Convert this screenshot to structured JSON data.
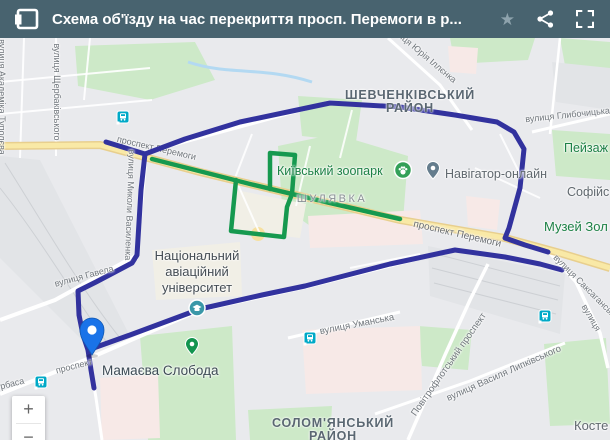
{
  "header": {
    "title": "Схема об'їзду на час перекриття просп. Перемоги в р...",
    "icons": [
      "open-panel-icon",
      "star-icon",
      "share-icon",
      "fullscreen-icon"
    ],
    "bg_color": "#48636f"
  },
  "map": {
    "route_colors": {
      "blue": "#32329e",
      "green": "#16994f"
    },
    "highway_color": "#f9e9a6",
    "marker_color": "#1a73e8",
    "transit_color": "#00a9c7",
    "districts": {
      "shevchenkivskyi_line1": "ШЕВЧЕНКІВСЬКИЙ",
      "shevchenkivskyi_line2": "РАЙОН",
      "solomianskyi_line1": "СОЛОМ'ЯНСЬКИЙ",
      "solomianskyi_line2": "РАЙОН",
      "shuliavka": "ШУЛЯВКА"
    },
    "places": {
      "zoo": "Київський зоопарк",
      "navigator": "Навігатор-онлайн",
      "university_line1": "Національний",
      "university_line2": "авіаційний",
      "university_line3": "університет",
      "mamaieva": "Мамаєва Слобода",
      "peizazh": "Пейзаж",
      "sofiis": "Софійс",
      "muzei": "Музей Зол",
      "koste": "Косте"
    },
    "streets": {
      "peremohy": "проспект Перемоги",
      "shcherbakivskoho": "вулиця Щербаківського",
      "tupoleva": "вулиця Академіка Туполєва",
      "vasylenka": "вулиця Миколи Василенка",
      "illienka": "вулиця Юрія Іллєнка",
      "hlybochytska": "вулиця Глибочицька",
      "saksahanskoho": "вулиця Саксаганського",
      "umanska": "вулиця Уманська",
      "povitroflotskyi": "Повітрофлотський проспект",
      "lypkivskoho": "вулиця Василя Липківського",
      "havela": "вулиця Гавела",
      "prospekt_fragment": "проспект",
      "kurbasa_fragment": "урбаса",
      "right_edge_fragment": "вулиця"
    }
  },
  "zoom_control": {
    "zoom_in": "+",
    "zoom_out": "−"
  }
}
